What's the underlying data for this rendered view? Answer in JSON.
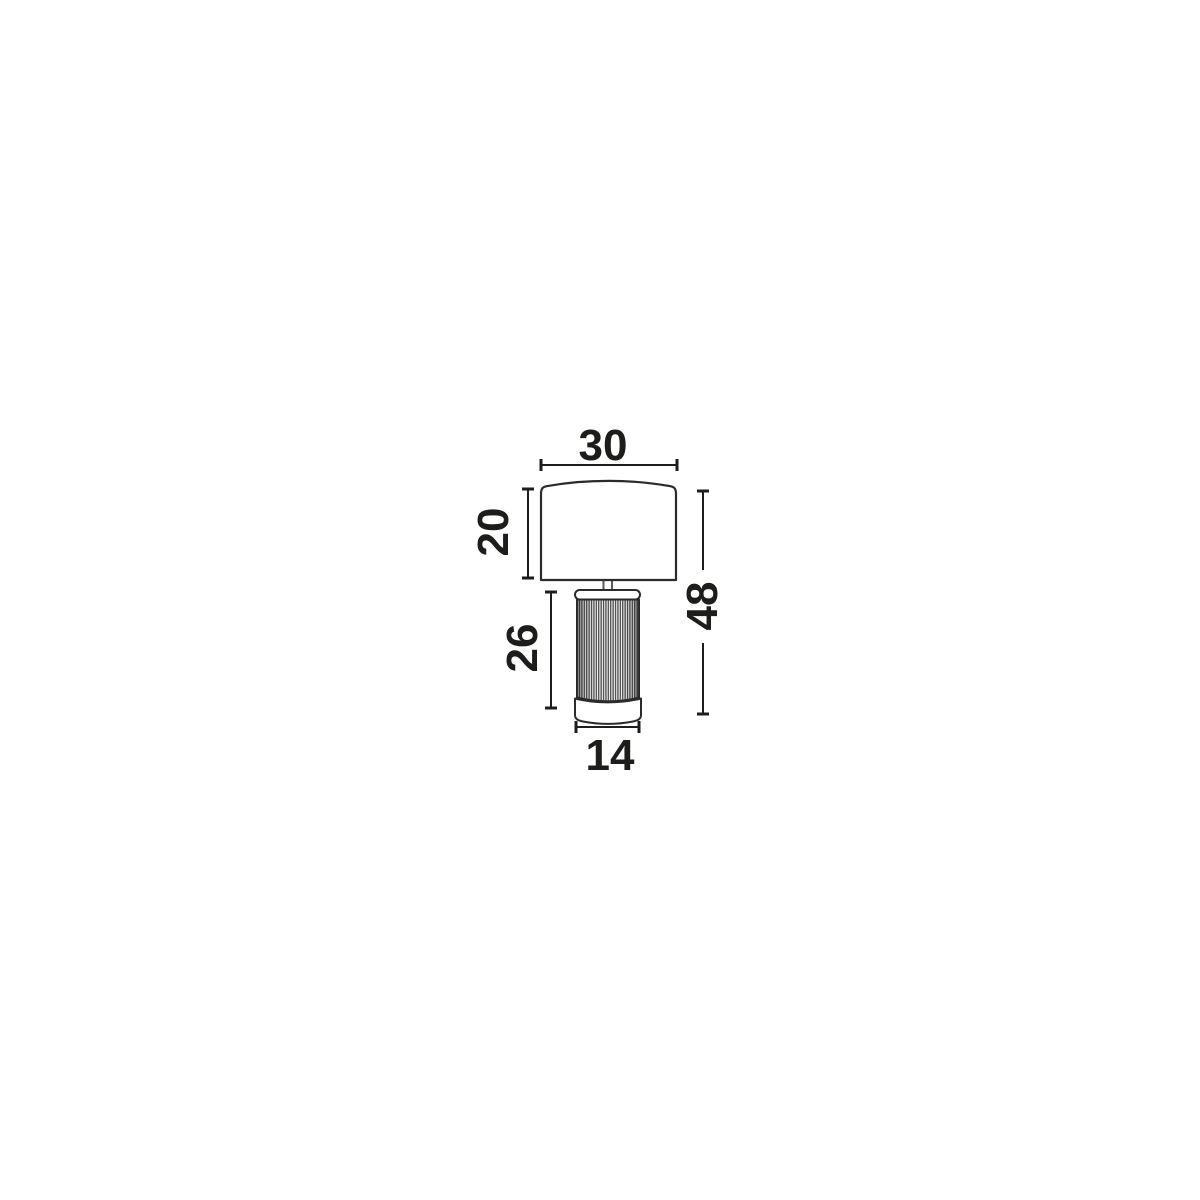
{
  "drawing": {
    "kind": "technical dimension drawing",
    "object": "table lamp with drum shade and fluted cylindrical base",
    "units_shown": "none (bare numbers)",
    "background_color": "#ffffff",
    "line_color": "#1d1d1b",
    "rib_fill_color": "#4a4a4a",
    "dimensions": {
      "shade_width": {
        "value": "30",
        "measures": "lamp shade width",
        "placement": "horizontal line above shade"
      },
      "shade_height": {
        "value": "20",
        "measures": "lamp shade height",
        "placement": "vertical line left of shade, label rotated 90° CCW"
      },
      "base_height": {
        "value": "26",
        "measures": "lamp base height",
        "placement": "vertical line left of base, label rotated 90° CCW"
      },
      "total_height": {
        "value": "48",
        "measures": "overall lamp height",
        "placement": "vertical line right of lamp, label rotated 90° CCW, line broken by label"
      },
      "base_width": {
        "value": "14",
        "measures": "lamp base width",
        "placement": "horizontal line below base"
      }
    }
  }
}
